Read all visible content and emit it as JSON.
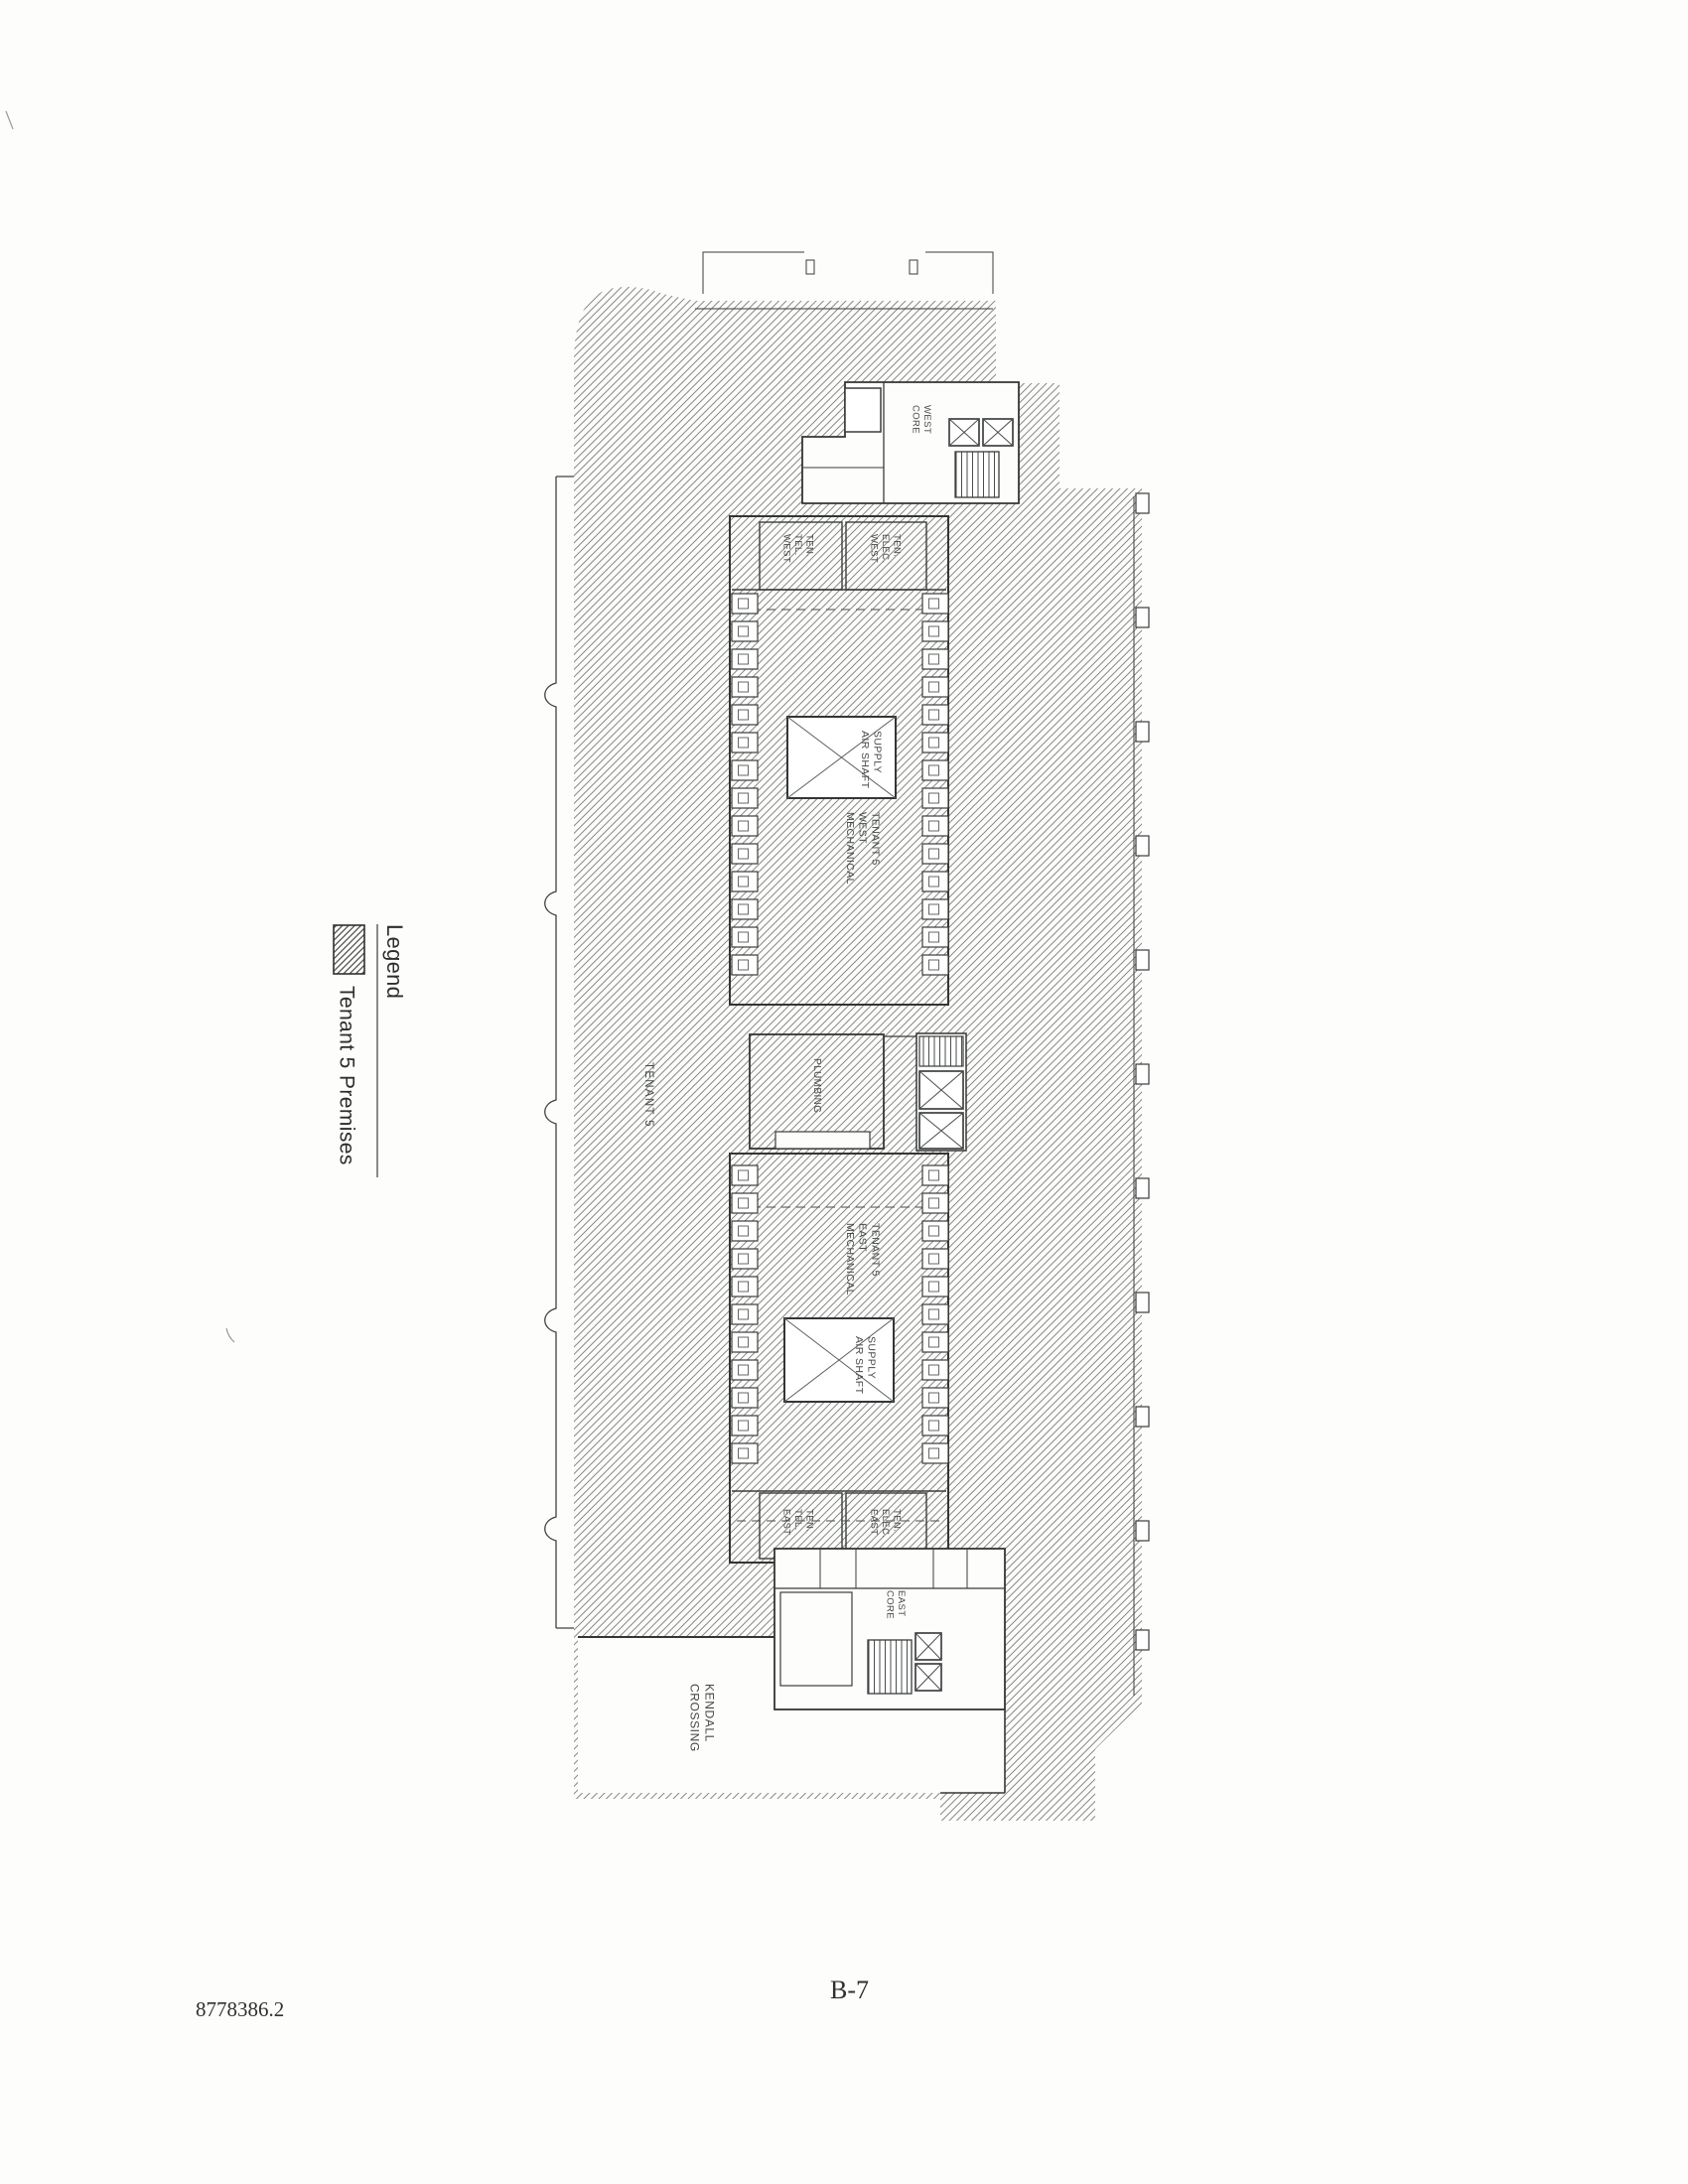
{
  "page": {
    "number": "B-7",
    "document_ref": "8778386.2"
  },
  "legend": {
    "title": "Legend",
    "items": [
      {
        "label": "Tenant 5 Premises",
        "pattern": "diagonal-hatch"
      }
    ]
  },
  "plan": {
    "tenant_area_label": "TENANT 5",
    "rooms": {
      "west_mechanical": "TENANT 5\nWEST\nMECHANICAL",
      "east_mechanical": "TENANT 5\nEAST\nMECHANICAL",
      "supply_air_shaft_west": "SUPPLY\nAIR SHAFT",
      "supply_air_shaft_east": "SUPPLY\nAIR SHAFT",
      "ten_tel_west": "TEN.\nTEL.\nWEST",
      "ten_elec_west": "TEN.\nELEC.\nWEST",
      "ten_tel_east": "TEN.\nTEL.\nEAST",
      "ten_elec_east": "TEN.\nELEC.\nEAST",
      "west_core": "WEST\nCORE",
      "east_core": "EAST\nCORE",
      "plumbing": "PLUMBING",
      "kendall_crossing": "KENDALL\nCROSSING"
    },
    "colors": {
      "ink": "#3a3d3b",
      "hatch": "#767b79",
      "paper": "#fdfdfb"
    }
  }
}
